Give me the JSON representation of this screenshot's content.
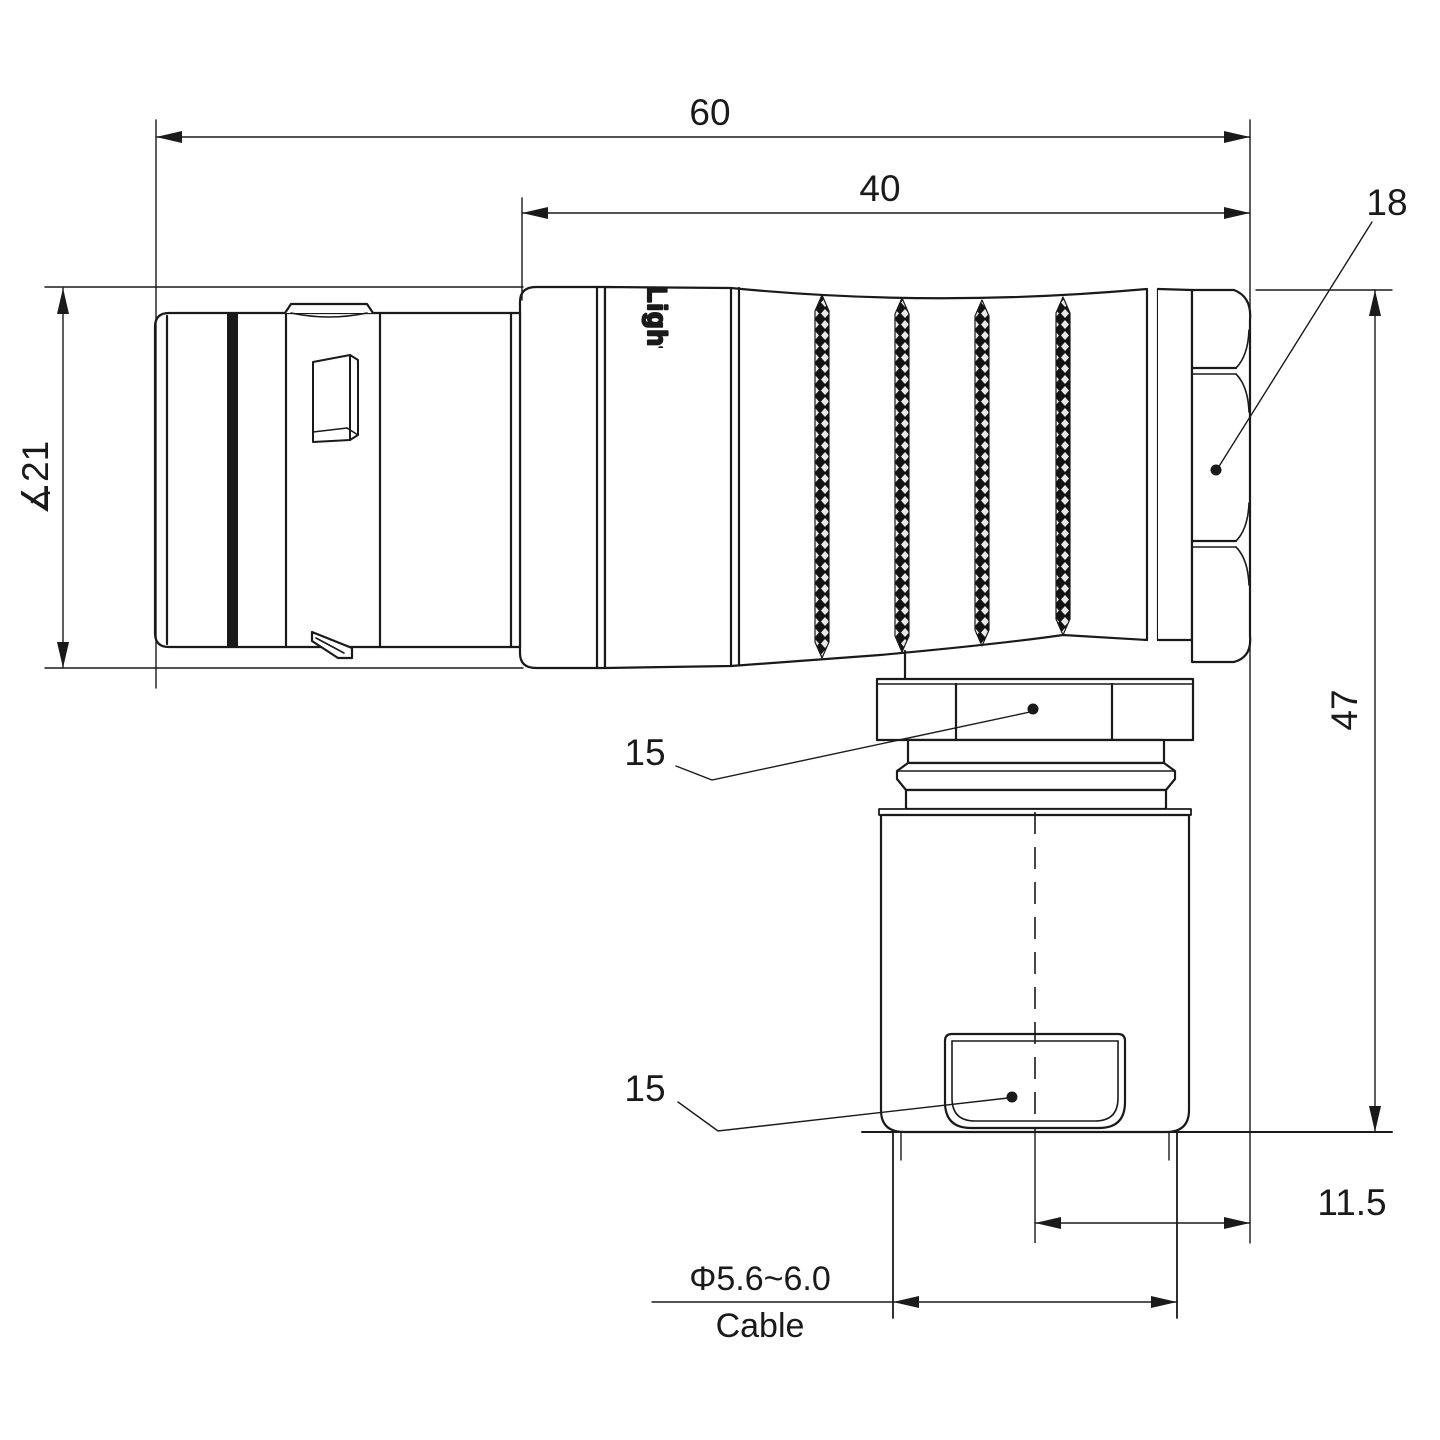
{
  "drawing": {
    "watermark": {
      "text": "Lightany",
      "color": "#f2bcbc"
    },
    "body_logo": {
      "text": "Lightany"
    },
    "colors": {
      "line": "#1a1a1a",
      "background": "#ffffff"
    },
    "dimensions": {
      "overall_length": "60",
      "grip_length": "40",
      "back_nut_across_flats": "18",
      "plug_diameter": "∡21",
      "overall_height": "47",
      "elbow_nut_across_flats": "15",
      "clamp_nut_across_flats": "15",
      "cable_offset": "11.5",
      "cable_diameter_range": "Φ5.6~6.0",
      "cable_label": "Cable"
    }
  }
}
